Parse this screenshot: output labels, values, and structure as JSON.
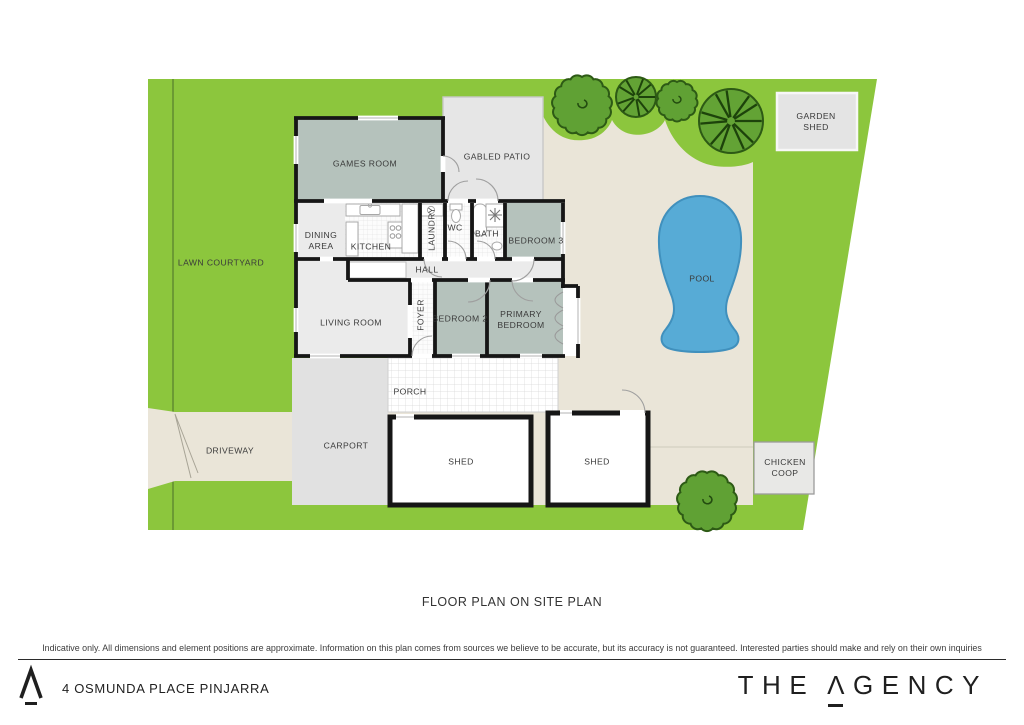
{
  "title": "FLOOR PLAN ON SITE PLAN",
  "disclaimer": "Indicative only. All dimensions and element positions are approximate. Information on this plan comes from sources we believe to be accurate, but its accuracy is not guaranteed. Interested parties should make and rely on their own inquiries",
  "labels": {
    "lawn_courtyard": "LAWN COURTYARD",
    "driveway": "DRIVEWAY",
    "games_room": "GAMES ROOM",
    "gabled_patio": "GABLED PATIO",
    "dining_area": "DINING AREA",
    "kitchen": "KITCHEN",
    "laundry": "LAUNDRY",
    "wc": "WC",
    "bath": "BATH",
    "bedroom_3": "BEDROOM 3",
    "hall": "HALL",
    "foyer": "FOYER",
    "living_room": "LIVING ROOM",
    "bedroom_2": "BEDROOM 2",
    "primary_bedroom": "PRIMARY BEDROOM",
    "porch": "PORCH",
    "carport": "CARPORT",
    "shed_left": "SHED",
    "shed_right": "SHED",
    "pool": "POOL",
    "garden_shed": "GARDEN SHED",
    "chicken_coop": "CHICKEN COOP"
  },
  "footer": {
    "address": "4 OSMUNDA PLACE PINJARRA",
    "brand": {
      "word1": "THE",
      "a_glyph": "Λ",
      "rest": "GENCY"
    }
  },
  "colors": {
    "lawn": "#8cc63d",
    "fence_line": "#6b9a33",
    "paving": "#eae5d8",
    "pool_water": "#57abd6",
    "room_fill": "#b5c2bc",
    "wall": "#161616",
    "tree_fill": "#60a134",
    "tree_outline": "#2d5a15"
  }
}
